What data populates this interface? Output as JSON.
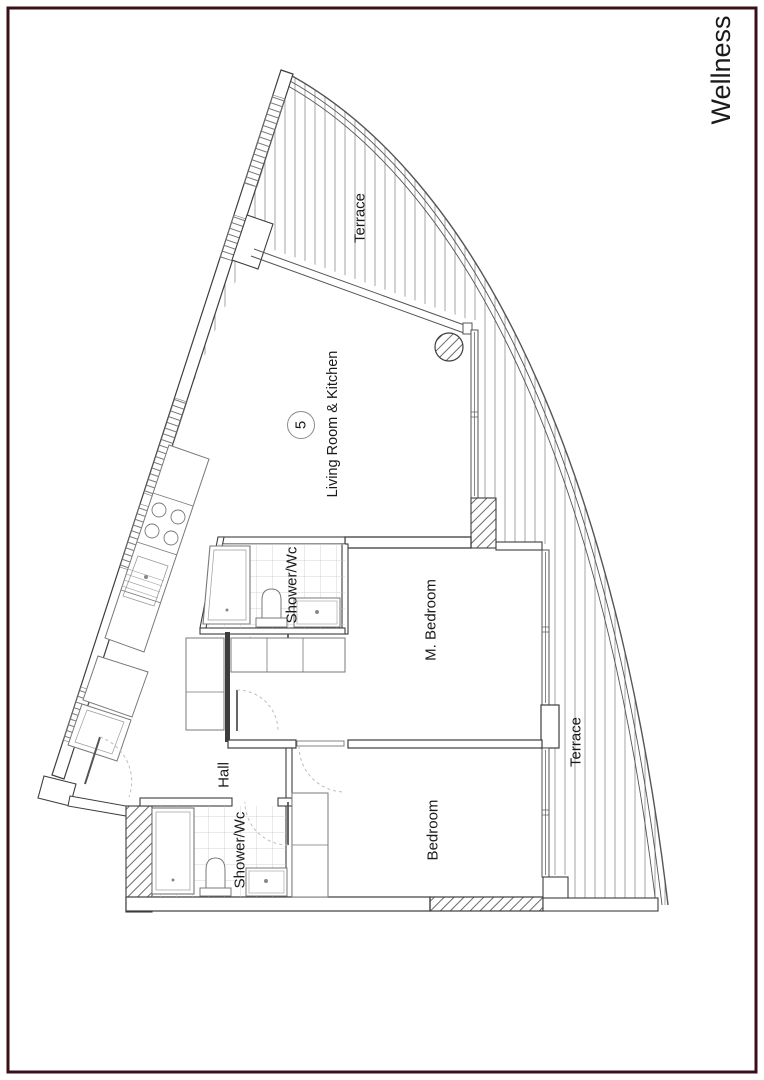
{
  "page": {
    "vertical_title": "Wellness"
  },
  "colors": {
    "frame": "#3a1018",
    "wall_line": "#3d3d3d",
    "fixture_line": "#787878",
    "deck_line": "#9a9a9a",
    "tile_line": "#c9c9c9",
    "text": "#1a1a1a"
  },
  "plan": {
    "unit_number": "5",
    "labels": {
      "terrace_top": "Terrace",
      "living_room_kitchen": "Living Room & Kitchen",
      "shower_wc_upper": "Shower/Wc",
      "m_bedroom": "M. Bedroom",
      "terrace_right": "Terrace",
      "hall": "Hall",
      "shower_wc_lower": "Shower/Wc",
      "bedroom": "Bedroom"
    }
  }
}
